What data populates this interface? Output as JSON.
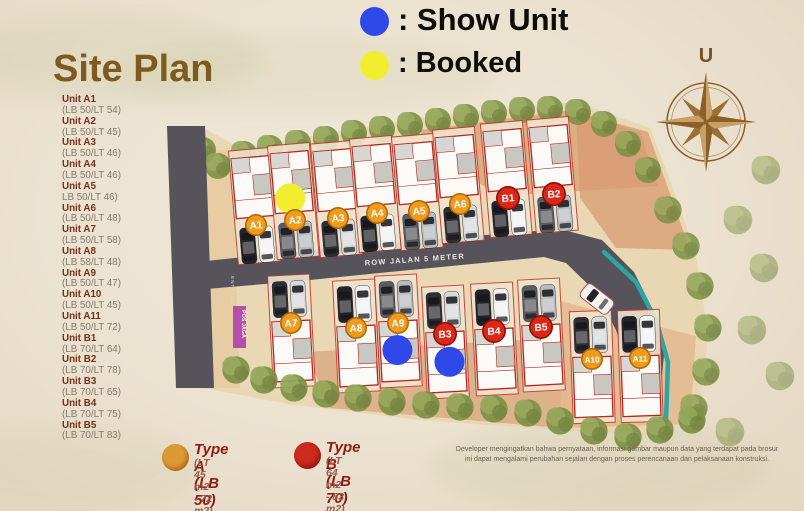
{
  "title": "Site Plan",
  "legend": {
    "show_unit": {
      "label": ": Show Unit",
      "color": "#2f49e8"
    },
    "booked": {
      "label": ": Booked",
      "color": "#f2ee2e"
    }
  },
  "compass": {
    "label": "U",
    "color": "#8a5f28"
  },
  "sidebar": {
    "units": [
      {
        "name": "Unit A1",
        "spec": "(LB 50/LT 54)"
      },
      {
        "name": "Unit A2",
        "spec": "(LB 50/LT 45)"
      },
      {
        "name": "Unit A3",
        "spec": "(LB 50/LT 46)"
      },
      {
        "name": "Unit A4",
        "spec": "(LB 50/LT 46)"
      },
      {
        "name": "Unit A5",
        "spec": "LB 50/LT 46)"
      },
      {
        "name": "Unit A6",
        "spec": "(LB 50/LT 48)"
      },
      {
        "name": "Unit A7",
        "spec": "(LB 50/LT 58)"
      },
      {
        "name": "Unit A8",
        "spec": "(LB 58/LT 48)"
      },
      {
        "name": "Unit A9",
        "spec": "(LB 50/LT 47)"
      },
      {
        "name": "Unit A10",
        "spec": "(LB 50/LT 45)"
      },
      {
        "name": "Unit A11",
        "spec": "(LB 50/LT 72)"
      },
      {
        "name": "Unit B1",
        "spec": "(LB 70/LT 64)"
      },
      {
        "name": "Unit B2",
        "spec": "(LB 70/LT 78)"
      },
      {
        "name": "Unit B3",
        "spec": "(LB 70/LT 65)"
      },
      {
        "name": "Unit B4",
        "spec": "(LB 70/LT 75)"
      },
      {
        "name": "Unit B5",
        "spec": "(LB 70/LT 83)"
      }
    ]
  },
  "map": {
    "road_label": "ROW JALAN 5 METER",
    "entrance_label": "ENTRANCE",
    "guard_post_label": "POS JAGA",
    "colors": {
      "type_a": "#f09b1b",
      "type_a_rim": "#b06a0c",
      "type_b": "#dc2718",
      "type_b_rim": "#8f0f08",
      "booked": "#f2ee2e",
      "show": "#2f49e8",
      "road": "#57535a",
      "drain": "#28a7a5",
      "guard_post": "#b043ae"
    },
    "units": [
      {
        "id": "A1",
        "type": "A",
        "row": "top",
        "x": 256,
        "y": 225,
        "rot": -5,
        "status": null
      },
      {
        "id": "A2",
        "type": "A",
        "row": "top",
        "x": 295,
        "y": 220,
        "rot": -5,
        "status": "booked",
        "status_dx": -3,
        "status_dy": -22
      },
      {
        "id": "A3",
        "type": "A",
        "row": "top",
        "x": 338,
        "y": 218,
        "rot": -5,
        "status": null
      },
      {
        "id": "A4",
        "type": "A",
        "row": "top",
        "x": 377,
        "y": 213,
        "rot": -5,
        "status": null
      },
      {
        "id": "A5",
        "type": "A",
        "row": "top",
        "x": 419,
        "y": 211,
        "rot": -5,
        "status": null
      },
      {
        "id": "A6",
        "type": "A",
        "row": "top",
        "x": 460,
        "y": 204,
        "rot": -5,
        "status": null
      },
      {
        "id": "B1",
        "type": "B",
        "row": "top",
        "x": 508,
        "y": 198,
        "rot": -5,
        "status": null
      },
      {
        "id": "B2",
        "type": "B",
        "row": "top",
        "x": 554,
        "y": 194,
        "rot": -5,
        "status": null
      },
      {
        "id": "A7",
        "type": "A",
        "row": "bottom",
        "x": 291,
        "y": 323,
        "rot": -3,
        "status": null
      },
      {
        "id": "A8",
        "type": "A",
        "row": "bottom",
        "x": 356,
        "y": 328,
        "rot": -3,
        "status": null
      },
      {
        "id": "A9",
        "type": "A",
        "row": "bottom",
        "x": 398,
        "y": 323,
        "rot": -3,
        "status": "show",
        "status_dx": -2,
        "status_dy": 27
      },
      {
        "id": "B3",
        "type": "B",
        "row": "bottom",
        "x": 445,
        "y": 334,
        "rot": -3,
        "status": "show",
        "status_dx": 3,
        "status_dy": 28
      },
      {
        "id": "B4",
        "type": "B",
        "row": "bottom",
        "x": 494,
        "y": 331,
        "rot": -3,
        "status": null
      },
      {
        "id": "B5",
        "type": "B",
        "row": "bottom",
        "x": 541,
        "y": 327,
        "rot": -3,
        "status": null
      },
      {
        "id": "A10",
        "type": "A",
        "row": "bottom",
        "x": 592,
        "y": 359,
        "rot": -2,
        "status": null
      },
      {
        "id": "A11",
        "type": "A",
        "row": "bottom",
        "x": 640,
        "y": 358,
        "rot": -2,
        "status": null
      }
    ]
  },
  "type_legend": {
    "type_a": {
      "title": "Type A (LB 50)",
      "subtitle": "(LT 45 m2 - 72 m2)",
      "color": "#dd9a33"
    },
    "type_b": {
      "title": "Type B (LB 70)",
      "subtitle": "(LT 64 m2 - 83 m2)",
      "color": "#cc2a1e"
    }
  },
  "disclaimer": {
    "line1": "Developer mengingatkan bahwa pernyataan, informasi gambar maupun data yang terdapat pada brosur",
    "line2": "ini dapat mengalami perubahan sejalan dengan proses perencanaan dan pelaksanaan konstruksi."
  }
}
